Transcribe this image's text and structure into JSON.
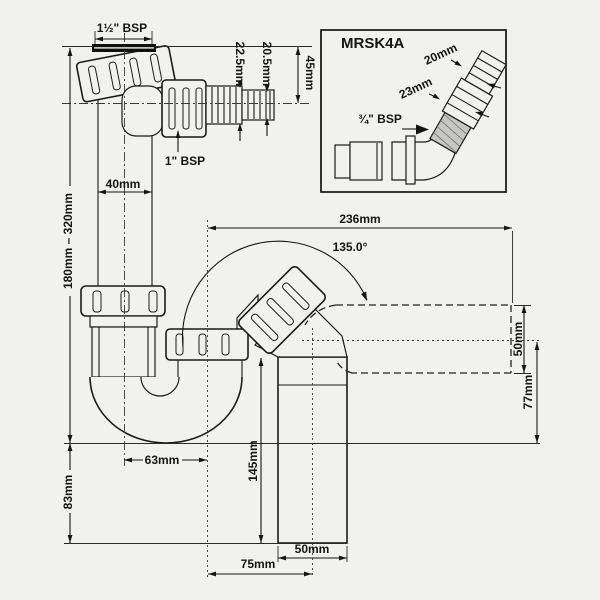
{
  "diagram": {
    "inset": {
      "product_code": "MRSK4A",
      "hose_small": "20mm",
      "hose_large": "23mm",
      "thread": "¾\" BSP"
    },
    "labels": {
      "inlet_thread": "1½\" BSP",
      "branch_thread": "1\" BSP"
    },
    "dims": {
      "hose_large_dia": "22.5mm",
      "hose_small_dia": "20.5mm",
      "inlet_drop": "45mm",
      "pipe_width": "40mm",
      "height_range": "180mm – 320mm",
      "water_seal": "83mm",
      "bend_offset": "63mm",
      "tail_length": "145mm",
      "overall_width": "236mm",
      "elbow_angle": "135.0°",
      "outlet_height": "50mm",
      "outlet_drop": "77mm",
      "outlet_offset": "75mm",
      "outlet_width": "50mm"
    }
  }
}
